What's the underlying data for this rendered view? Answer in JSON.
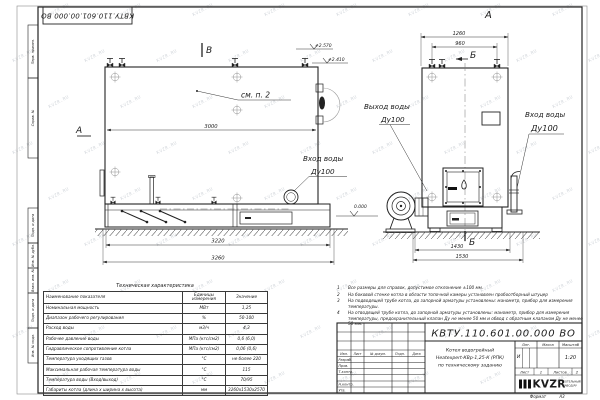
{
  "watermark": {
    "text": "KVZR.RU"
  },
  "frame": {
    "doc_number_top": "КВТУ.110.601.00.000 ВО",
    "stamp_cells": [
      {
        "label": "Перв. примен."
      },
      {
        "label": "Справ. №"
      },
      {
        "label": "Подп. и дата"
      },
      {
        "label": "Инв. № дубл."
      },
      {
        "label": "Взам. инв. №"
      },
      {
        "label": "Подп. и дата"
      },
      {
        "label": "Инв. № подл."
      }
    ],
    "format_label": "Формат",
    "format_value": "А3"
  },
  "drawing": {
    "left_view": {
      "section_b": "В",
      "section_a": "А",
      "note_ref": "см. п. 2",
      "dim_width": "3000",
      "dim_base": "3220",
      "dim_overall": "3260",
      "elev_top": "+2.570",
      "elev_mid": "+2.410",
      "elev_zero": "0.000",
      "inlet_label": "Вход воды",
      "inlet_dn": "Ду100"
    },
    "right_view": {
      "view_label": "А",
      "section_b_top": "Б",
      "section_b_bottom": "Б",
      "dim_top_outer": "1260",
      "dim_top_inner": "960",
      "dim_bottom_inner": "1430",
      "dim_bottom_outer": "1530",
      "outlet_label": "Выход воды",
      "outlet_dn": "Ду100",
      "inlet_label": "Вход воды",
      "inlet_dn": "Ду100"
    }
  },
  "tech_table": {
    "title": "Техническая характеристика",
    "headers": [
      "Наименование показателя",
      "Единицы измерения",
      "Значение"
    ],
    "rows": [
      [
        "Номинальная мощность",
        "МВт",
        "1,25"
      ],
      [
        "Диапазон рабочего регулирования",
        "%",
        "50-100"
      ],
      [
        "Расход воды",
        "м3/ч",
        "4,3"
      ],
      [
        "Рабочее давление воды",
        "МПа (кгс/см2)",
        "0,6 (6,0)"
      ],
      [
        "Гидравлическое сопротивление котла",
        "МПа (кгс/см2)",
        "0,06 (0,6)"
      ],
      [
        "Температура уходящих газов",
        "°С",
        "не более 220"
      ],
      [
        "Максимальная рабочая температура воды",
        "°С",
        "115"
      ],
      [
        "Температура воды (Вход/выход)",
        "°С",
        "70/95"
      ],
      [
        "Габариты котла (длина х ширина х высота)",
        "мм",
        "3260х1530х2570"
      ]
    ]
  },
  "notes": {
    "items": [
      {
        "n": "1",
        "text": "Все размеры для справок, допустимое отклонение ±100 мм."
      },
      {
        "n": "2",
        "text": "На боковой стенке котла в области топочной камеры установлен пробоотборный штуцер"
      },
      {
        "n": "3",
        "text": "На подводящей трубе котла, до запорной арматуры установлены: манометр, прибор для измерения температуры."
      },
      {
        "n": "4",
        "text": "На отводящей трубе котла, до запорной арматуры установлены: манометр, прибор для измерения температуры, предохранительный клапан Ду не менее 50 мм и обвод с обратным клапаном Ду не менее 50 мм."
      }
    ]
  },
  "title_block": {
    "doc_number": "КВТУ.110.601.00.000 ВО",
    "product_line1": "Котел водогрейный",
    "product_line2": "Heatexpert-КВр-1,25-К (РПК)",
    "product_line3": "по техническому заданию",
    "lit_header": "Лит.",
    "mass_header": "Масса",
    "scale_header": "Масштаб",
    "lit_value": "И",
    "scale_value": "1:20",
    "sheet_label": "Лист",
    "sheet_value": "1",
    "sheets_label": "Листов",
    "sheets_value": "2",
    "col_izm": "Изм.",
    "col_list": "Лист",
    "col_doc": "№ докум.",
    "col_podp": "Подп.",
    "col_data": "Дата",
    "roles": [
      "Разраб.",
      "Пров.",
      "Т.контр.",
      "Н.контр.",
      "Утв."
    ],
    "logo_text": "KVZR",
    "logo_sub1": "КОТЕЛЬНЫЙ",
    "logo_sub2": "ЗАВОД.РУ"
  }
}
